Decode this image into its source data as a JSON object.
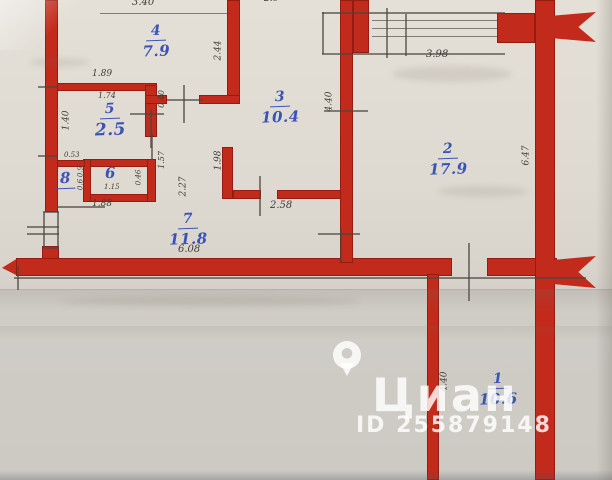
{
  "rooms": {
    "r1": {
      "num": "1",
      "area": "10.6"
    },
    "r2": {
      "num": "2",
      "area": "17.9"
    },
    "r3": {
      "num": "3",
      "area": "10.4"
    },
    "r4": {
      "num": "4",
      "area": "7.9"
    },
    "r5": {
      "num": "5",
      "area": "2.5"
    },
    "r6": {
      "num": "6"
    },
    "r7": {
      "num": "7",
      "area": "11.8"
    },
    "r8": {
      "num": "8"
    }
  },
  "dims": {
    "top_width": "3.40",
    "top_partial": "2.6",
    "room4_right": "2.44",
    "room5_above": "1.89",
    "room5_top": "1.74",
    "room5_left": "1.40",
    "door_room5": "0.40",
    "hall_157": "1.57",
    "hall_227": "2.27",
    "hall_198": "1.98",
    "room6_above": "0.53",
    "room6_inner": "1.15",
    "room6_right": "0.46",
    "room6_below": "1.88",
    "room8_a": "0.9",
    "room8_b": "0.6",
    "room7_width": "6.08",
    "room3_door": "2.58",
    "room3_left": "4.40",
    "balcony_width": "3.98",
    "room2_right": "6.47",
    "room1_left": "4.40"
  },
  "watermark": {
    "brand": "Циан",
    "id_label": "ID 255879148"
  },
  "colors": {
    "wall_red": "#c22a1c",
    "ink_blue": "#3b53b6",
    "pencil": "#4a463f",
    "paper": "#dcd8d0",
    "watermark": "#ffffff"
  }
}
